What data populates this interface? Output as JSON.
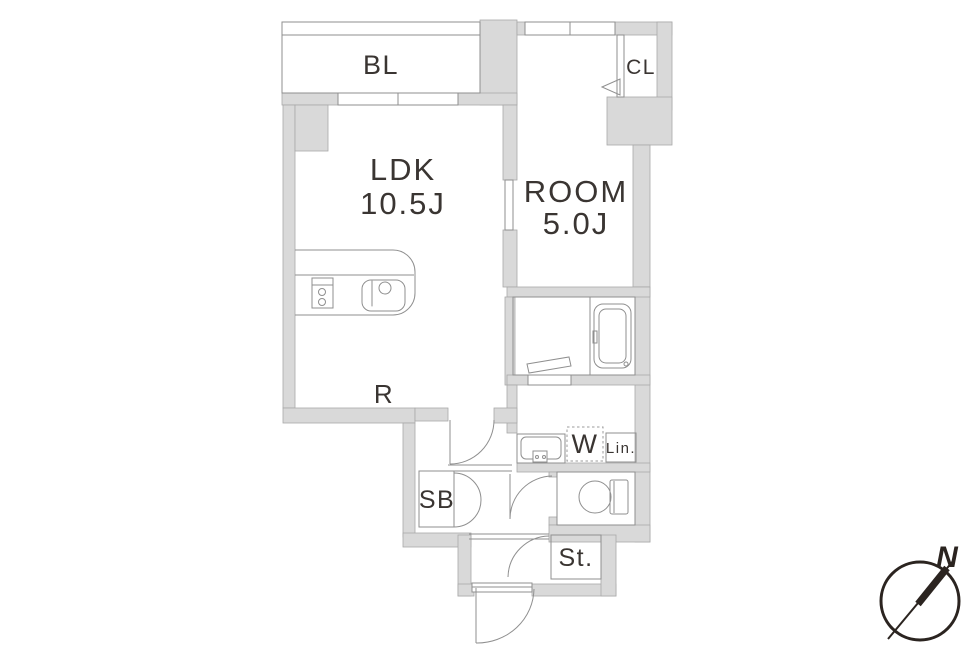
{
  "floorplan": {
    "rooms": {
      "balcony": {
        "label": "BL"
      },
      "closet": {
        "label": "CL"
      },
      "ldk": {
        "label": "LDK",
        "size": "10.5J"
      },
      "bedroom": {
        "label": "ROOM",
        "size": "5.0J"
      }
    },
    "fixtures": {
      "refrigerator": "R",
      "washing_machine": "W",
      "linen": "Lin.",
      "shoe_box": "SB",
      "storage": "St."
    },
    "compass": {
      "north": "N"
    },
    "colors": {
      "wall_fill": "#d9d9d9",
      "wall_stroke": "#a9a9a9",
      "fixture_line": "#8f8f8f",
      "text": "#3a3532",
      "compass": "#2b2420"
    }
  }
}
